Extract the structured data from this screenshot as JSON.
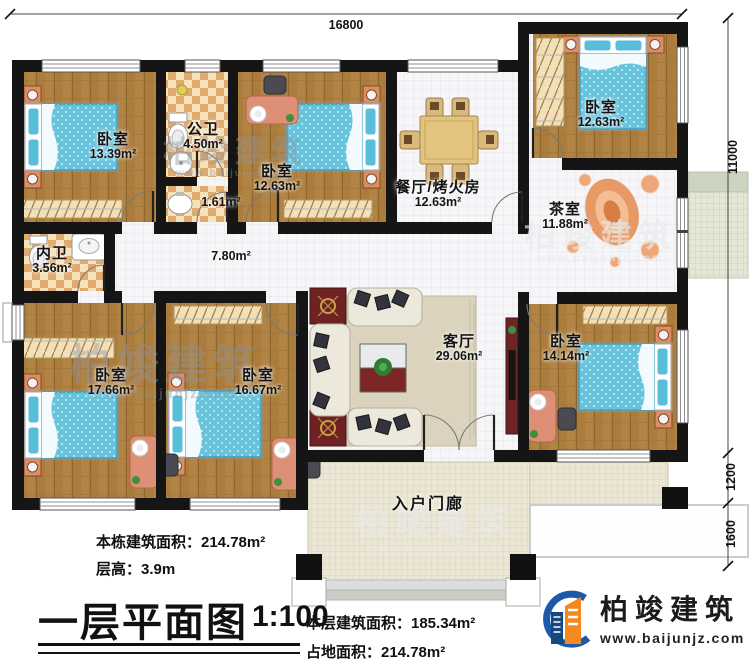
{
  "plan": {
    "dimensions": {
      "width_top": "16800",
      "height_right": "11000",
      "porch_depth_1": "1200",
      "porch_depth_2": "1600"
    },
    "rooms": [
      {
        "id": "bedroom-top-left",
        "name": "卧室",
        "area": "13.39m²"
      },
      {
        "id": "public-bathroom",
        "name": "公卫",
        "area": "4.50m²"
      },
      {
        "id": "utility",
        "name": "",
        "area": "1.61m²"
      },
      {
        "id": "bedroom-top-middle",
        "name": "卧室",
        "area": "12.63m²"
      },
      {
        "id": "dining-fire-room",
        "name": "餐厅/烤火房",
        "area": "12.63m²"
      },
      {
        "id": "bedroom-top-right",
        "name": "卧室",
        "area": "12.63m²"
      },
      {
        "id": "tea-room",
        "name": "茶室",
        "area": "11.88m²"
      },
      {
        "id": "inner-bathroom",
        "name": "内卫",
        "area": "3.56m²"
      },
      {
        "id": "hallway",
        "name": "",
        "area": "7.80m²"
      },
      {
        "id": "bedroom-bottom-left",
        "name": "卧室",
        "area": "17.66m²"
      },
      {
        "id": "bedroom-bottom-mid",
        "name": "卧室",
        "area": "16.67m²"
      },
      {
        "id": "living-room",
        "name": "客厅",
        "area": "29.06m²"
      },
      {
        "id": "bedroom-bottom-right",
        "name": "卧室",
        "area": "14.14m²"
      },
      {
        "id": "entry-porch",
        "name": "入户门廊",
        "area": ""
      }
    ]
  },
  "title_block": {
    "building_area": "本栋建筑面积：214.78m²",
    "floor_height": "层高：3.9m",
    "plan_title": "一层平面图",
    "scale": "1:100",
    "floor_area": "本层建筑面积：185.34m²",
    "footprint_area": "占地面积：214.78m²"
  },
  "branding": {
    "company": "柏竣建筑",
    "website": "www.baijunjz.com",
    "logo_blue": "#1a5aa8",
    "logo_orange": "#f5891d"
  },
  "watermark": {
    "text": "柏竣建筑",
    "website": "www.baijunjz.com"
  }
}
